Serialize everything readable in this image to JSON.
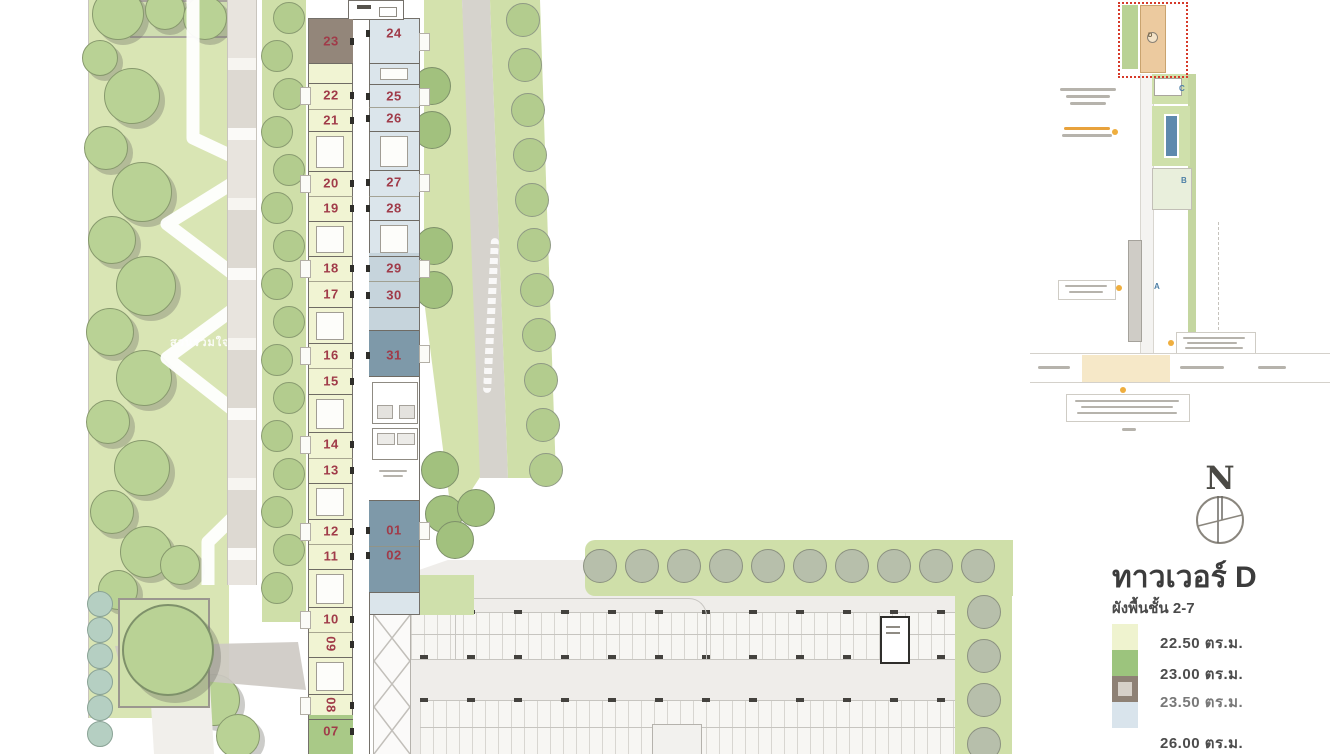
{
  "title": {
    "text": "ทาวเวอร์ D",
    "subtitle": "ผังพื้นชั้น 2-7"
  },
  "compass": {
    "north_label": "N"
  },
  "garden": {
    "label": "สวนรวมใจ"
  },
  "legend": {
    "items": [
      {
        "label": "22.50 ตร.ม.",
        "color": "#eff3cf",
        "style": "solid"
      },
      {
        "label": "23.00 ตร.ม.",
        "color": "#9cc47d",
        "style": "solid"
      },
      {
        "label": "23.50 ตร.ม.",
        "color": "#8e8175",
        "style": "bordered"
      },
      {
        "label": "26.00 ตร.ม.",
        "color": "#d9e4ec",
        "style": "solid"
      }
    ]
  },
  "keyplan": {
    "highlight_tower": "D",
    "towers": [
      "D",
      "C",
      "B",
      "A"
    ]
  },
  "floorplan": {
    "left_units": [
      {
        "no": "23",
        "area": "23.50",
        "cy": 41,
        "fill": "brown"
      },
      {
        "no": "22",
        "area": "22.50",
        "cy": 95
      },
      {
        "no": "21",
        "area": "22.50",
        "cy": 120
      },
      {
        "no": "20",
        "area": "22.50",
        "cy": 183
      },
      {
        "no": "19",
        "area": "22.50",
        "cy": 208
      },
      {
        "no": "18",
        "area": "22.50",
        "cy": 268
      },
      {
        "no": "17",
        "area": "22.50",
        "cy": 294
      },
      {
        "no": "16",
        "area": "22.50",
        "cy": 355
      },
      {
        "no": "15",
        "area": "22.50",
        "cy": 381
      },
      {
        "no": "14",
        "area": "22.50",
        "cy": 444
      },
      {
        "no": "13",
        "area": "22.50",
        "cy": 470
      },
      {
        "no": "12",
        "area": "22.50",
        "cy": 531
      },
      {
        "no": "11",
        "area": "22.50",
        "cy": 556
      },
      {
        "no": "10",
        "area": "22.50",
        "cy": 619
      },
      {
        "no": "09",
        "area": "22.50",
        "cy": 644,
        "rot": true
      },
      {
        "no": "08",
        "area": "22.50",
        "cy": 705,
        "rot": true
      },
      {
        "no": "07",
        "area": "23.00",
        "cy": 731,
        "fill": "green"
      }
    ],
    "right_units": [
      {
        "no": "24",
        "area": "26.00",
        "cy": 33
      },
      {
        "no": "25",
        "area": "26.00",
        "cy": 96
      },
      {
        "no": "26",
        "area": "26.00",
        "cy": 118
      },
      {
        "no": "27",
        "area": "26.00",
        "cy": 182
      },
      {
        "no": "28",
        "area": "26.00",
        "cy": 208
      },
      {
        "no": "29",
        "area": "26.00",
        "cy": 268
      },
      {
        "no": "30",
        "area": "26.00",
        "cy": 295
      },
      {
        "no": "31",
        "area": "26.00",
        "cy": 355,
        "fill": "dark"
      },
      {
        "no": "01",
        "area": "26.00",
        "cy": 530,
        "fill": "dark"
      },
      {
        "no": "02",
        "area": "26.00",
        "cy": 555,
        "fill": "dark"
      }
    ]
  }
}
